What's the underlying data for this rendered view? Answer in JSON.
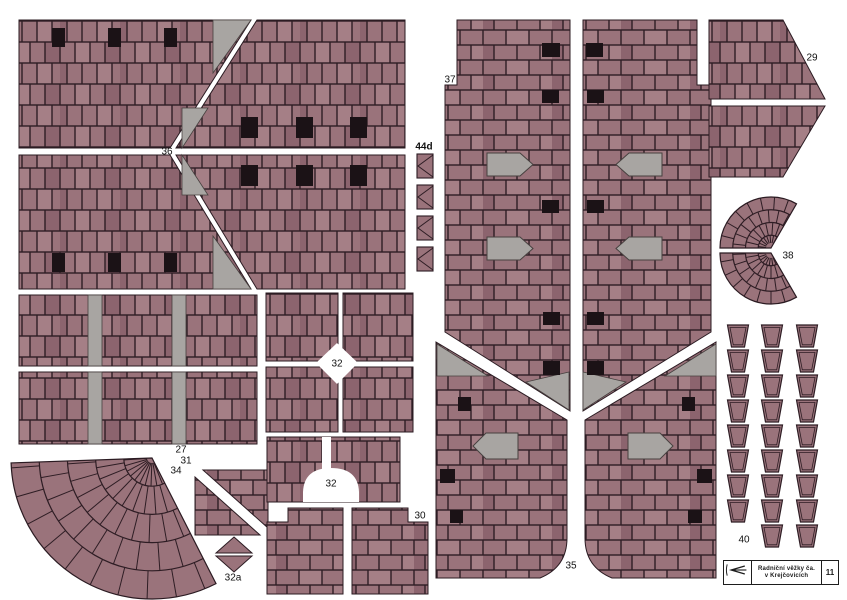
{
  "page": {
    "width": 847,
    "height": 600,
    "background": "#ffffff"
  },
  "palette": {
    "brick": "#9a737b",
    "brick_dark": "#8c646e",
    "brick_light": "#a57f86",
    "mortar": "#2e1d24",
    "gray": "#a8a5a2",
    "gray_stroke": "#47403f",
    "window": "#1b1216",
    "outline": "#2b1b22",
    "label": "#111111",
    "white": "#ffffff"
  },
  "labels": [
    {
      "text": "36",
      "x": 167,
      "y": 152
    },
    {
      "text": "44d",
      "x": 424,
      "y": 147,
      "bold": true
    },
    {
      "text": "37",
      "x": 450,
      "y": 80
    },
    {
      "text": "29",
      "x": 812,
      "y": 58
    },
    {
      "text": "38",
      "x": 788,
      "y": 256
    },
    {
      "text": "27",
      "x": 181,
      "y": 450
    },
    {
      "text": "31",
      "x": 186,
      "y": 461
    },
    {
      "text": "32",
      "x": 337,
      "y": 364
    },
    {
      "text": "32",
      "x": 331,
      "y": 484
    },
    {
      "text": "32a",
      "x": 233,
      "y": 578
    },
    {
      "text": "34",
      "x": 176,
      "y": 471
    },
    {
      "text": "30",
      "x": 420,
      "y": 516
    },
    {
      "text": "35",
      "x": 571,
      "y": 566
    },
    {
      "text": "40",
      "x": 744,
      "y": 540
    }
  ],
  "pieces": [
    {
      "id": "36-top-left",
      "fill": "v",
      "poly": [
        [
          19,
          20
        ],
        [
          251,
          20
        ],
        [
          170,
          148
        ],
        [
          19,
          148
        ]
      ]
    },
    {
      "id": "36-bottom-left",
      "fill": "v",
      "poly": [
        [
          19,
          155
        ],
        [
          170,
          155
        ],
        [
          251,
          289
        ],
        [
          19,
          289
        ]
      ]
    },
    {
      "id": "36-top-right",
      "fill": "v",
      "poly": [
        [
          257,
          20
        ],
        [
          405,
          20
        ],
        [
          405,
          148
        ],
        [
          176,
          148
        ]
      ]
    },
    {
      "id": "36-bottom-right",
      "fill": "v",
      "poly": [
        [
          176,
          155
        ],
        [
          405,
          155
        ],
        [
          405,
          289
        ],
        [
          257,
          289
        ]
      ]
    },
    {
      "id": "27-top",
      "fill": "v",
      "poly": [
        [
          19,
          295
        ],
        [
          257,
          295
        ],
        [
          257,
          366
        ],
        [
          19,
          366
        ]
      ]
    },
    {
      "id": "27-bottom",
      "fill": "v",
      "poly": [
        [
          19,
          372
        ],
        [
          257,
          372
        ],
        [
          257,
          444
        ],
        [
          19,
          444
        ]
      ]
    },
    {
      "id": "31-upper",
      "fill": "h",
      "poly": [
        [
          203,
          470
        ],
        [
          268,
          470
        ],
        [
          268,
          528
        ]
      ]
    },
    {
      "id": "31-lower",
      "fill": "h",
      "poly": [
        [
          195,
          477
        ],
        [
          260,
          535
        ],
        [
          195,
          535
        ]
      ]
    },
    {
      "id": "32a-top",
      "fill": "b",
      "poly": [
        [
          234,
          537
        ],
        [
          252,
          553
        ],
        [
          216,
          553
        ]
      ]
    },
    {
      "id": "32a-bottom",
      "fill": "b",
      "poly": [
        [
          216,
          556
        ],
        [
          252,
          556
        ],
        [
          234,
          572
        ]
      ]
    },
    {
      "id": "32-q1",
      "fill": "v",
      "poly": [
        [
          266,
          293
        ],
        [
          338,
          293
        ],
        [
          338,
          361
        ],
        [
          266,
          361
        ]
      ]
    },
    {
      "id": "32-q2",
      "fill": "v",
      "poly": [
        [
          343,
          293
        ],
        [
          413,
          293
        ],
        [
          413,
          361
        ],
        [
          343,
          361
        ]
      ]
    },
    {
      "id": "32-q3",
      "fill": "v",
      "poly": [
        [
          266,
          367
        ],
        [
          338,
          367
        ],
        [
          338,
          432
        ],
        [
          266,
          432
        ]
      ]
    },
    {
      "id": "32-q4",
      "fill": "v",
      "poly": [
        [
          343,
          367
        ],
        [
          413,
          367
        ],
        [
          413,
          432
        ],
        [
          343,
          432
        ]
      ]
    },
    {
      "id": "32-arch",
      "fill": "v",
      "poly": [
        [
          267,
          437
        ],
        [
          400,
          437
        ],
        [
          400,
          502
        ],
        [
          267,
          502
        ]
      ]
    },
    {
      "id": "30-left",
      "fill": "h",
      "poly": [
        [
          267,
          522
        ],
        [
          288,
          522
        ],
        [
          288,
          508
        ],
        [
          343,
          508
        ],
        [
          343,
          594
        ],
        [
          267,
          594
        ]
      ]
    },
    {
      "id": "30-right",
      "fill": "h",
      "poly": [
        [
          352,
          508
        ],
        [
          408,
          508
        ],
        [
          408,
          522
        ],
        [
          428,
          522
        ],
        [
          428,
          594
        ],
        [
          352,
          594
        ]
      ]
    },
    {
      "id": "37-left",
      "fill": "h",
      "poly": [
        [
          457,
          20
        ],
        [
          570,
          20
        ],
        [
          570,
          411
        ],
        [
          445,
          332
        ],
        [
          445,
          85
        ],
        [
          457,
          85
        ]
      ]
    },
    {
      "id": "37-right",
      "fill": "h",
      "poly": [
        [
          583,
          20
        ],
        [
          697,
          20
        ],
        [
          697,
          85
        ],
        [
          711,
          85
        ],
        [
          711,
          332
        ],
        [
          583,
          411
        ]
      ]
    },
    {
      "id": "35-left",
      "fill": "h",
      "path": "M436,342 L567,420 L567,538 Q567,567 540,578 L436,578 Z"
    },
    {
      "id": "35-right",
      "fill": "h",
      "path": "M716,342 L716,578 L612,578 Q585,567 585,538 L585,420 Z"
    },
    {
      "id": "29-top",
      "fill": "v",
      "poly": [
        [
          709,
          20
        ],
        [
          783,
          20
        ],
        [
          825,
          99
        ],
        [
          709,
          99
        ]
      ]
    },
    {
      "id": "29-bottom",
      "fill": "v",
      "poly": [
        [
          709,
          106
        ],
        [
          825,
          106
        ],
        [
          783,
          177
        ],
        [
          709,
          177
        ]
      ]
    }
  ],
  "gray_rects": [
    [
      88,
      295,
      14,
      71
    ],
    [
      172,
      295,
      14,
      71
    ],
    [
      88,
      372,
      14,
      72
    ],
    [
      172,
      372,
      14,
      72
    ]
  ],
  "gray_tris": [
    [
      [
        213,
        20
      ],
      [
        251,
        20
      ],
      [
        213,
        73
      ]
    ],
    [
      [
        213,
        289
      ],
      [
        251,
        289
      ],
      [
        213,
        236
      ]
    ],
    [
      [
        182,
        108
      ],
      [
        208,
        108
      ],
      [
        182,
        148
      ]
    ],
    [
      [
        182,
        195
      ],
      [
        208,
        195
      ],
      [
        182,
        155
      ]
    ],
    [
      [
        569,
        372
      ],
      [
        569,
        410
      ],
      [
        526,
        382
      ]
    ],
    [
      [
        583,
        372
      ],
      [
        583,
        410
      ],
      [
        626,
        382
      ]
    ],
    [
      [
        437,
        344
      ],
      [
        488,
        376
      ],
      [
        437,
        376
      ]
    ],
    [
      [
        716,
        344
      ],
      [
        665,
        376
      ],
      [
        716,
        376
      ]
    ]
  ],
  "windows": [
    [
      52,
      28,
      13,
      19
    ],
    [
      108,
      28,
      13,
      19
    ],
    [
      164,
      28,
      13,
      19
    ],
    [
      52,
      253,
      13,
      19
    ],
    [
      108,
      253,
      13,
      19
    ],
    [
      164,
      253,
      13,
      19
    ],
    [
      241,
      117,
      17,
      21
    ],
    [
      296,
      117,
      17,
      21
    ],
    [
      350,
      117,
      17,
      21
    ],
    [
      241,
      165,
      17,
      21
    ],
    [
      296,
      165,
      17,
      21
    ],
    [
      350,
      165,
      17,
      21
    ],
    [
      542,
      43,
      18,
      14
    ],
    [
      542,
      90,
      17,
      13
    ],
    [
      542,
      200,
      17,
      13
    ],
    [
      543,
      312,
      17,
      13
    ],
    [
      543,
      361,
      17,
      14
    ],
    [
      586,
      43,
      17,
      14
    ],
    [
      587,
      90,
      17,
      13
    ],
    [
      587,
      200,
      17,
      13
    ],
    [
      587,
      312,
      17,
      13
    ],
    [
      587,
      361,
      17,
      14
    ],
    [
      440,
      469,
      15,
      14
    ],
    [
      458,
      397,
      13,
      14
    ],
    [
      450,
      510,
      13,
      13
    ],
    [
      697,
      469,
      15,
      14
    ],
    [
      682,
      397,
      13,
      14
    ],
    [
      688,
      510,
      14,
      13
    ]
  ],
  "dormers": [
    {
      "x": 487,
      "y": 153,
      "w": 46,
      "h": 23,
      "dir": "r"
    },
    {
      "x": 487,
      "y": 237,
      "w": 46,
      "h": 23,
      "dir": "r"
    },
    {
      "x": 616,
      "y": 153,
      "w": 46,
      "h": 23,
      "dir": "l"
    },
    {
      "x": 616,
      "y": 237,
      "w": 46,
      "h": 23,
      "dir": "l"
    },
    {
      "x": 473,
      "y": 433,
      "w": 45,
      "h": 26,
      "dir": "l"
    },
    {
      "x": 628,
      "y": 433,
      "w": 45,
      "h": 26,
      "dir": "r"
    }
  ],
  "white_cutouts": [
    {
      "path": "M322,437 L331,437 L331,470 L322,470 Z"
    },
    {
      "path": "M303,502 L303,492 Q304,468 331,468 Q358,468 359,492 L359,502 Z"
    },
    {
      "poly": [
        [
          337,
          343
        ],
        [
          358,
          363
        ],
        [
          337,
          384
        ],
        [
          316,
          363
        ]
      ]
    }
  ],
  "fans": [
    {
      "id": "38-top",
      "cx": 771,
      "cy": 248,
      "r": 51,
      "a0": 60,
      "a1": 180,
      "rings": 4,
      "step": 16
    },
    {
      "id": "38-bottom",
      "cx": 771,
      "cy": 253,
      "r": 51,
      "a0": 180,
      "a1": 300,
      "rings": 4,
      "step": 16
    },
    {
      "id": "34-fan",
      "cx": 152,
      "cy": 458,
      "r": 141,
      "a0": 182,
      "a1": 297,
      "rings": 5,
      "step": 12
    }
  ],
  "pots": {
    "cols": [
      738,
      772,
      807
    ],
    "row_y0": 325,
    "row_dy": 25,
    "rows_full": 8,
    "extra_row_cols": [
      772,
      807
    ],
    "top_w": 21,
    "bottom_w": 13,
    "h": 22
  },
  "strips_44d": {
    "x": 417,
    "w": 16,
    "h": 24,
    "ys": [
      154,
      185,
      216,
      247
    ]
  },
  "logo": {
    "line1": "Radniční věžky ča.",
    "line2": "v Krejčovicích",
    "number": "11"
  }
}
